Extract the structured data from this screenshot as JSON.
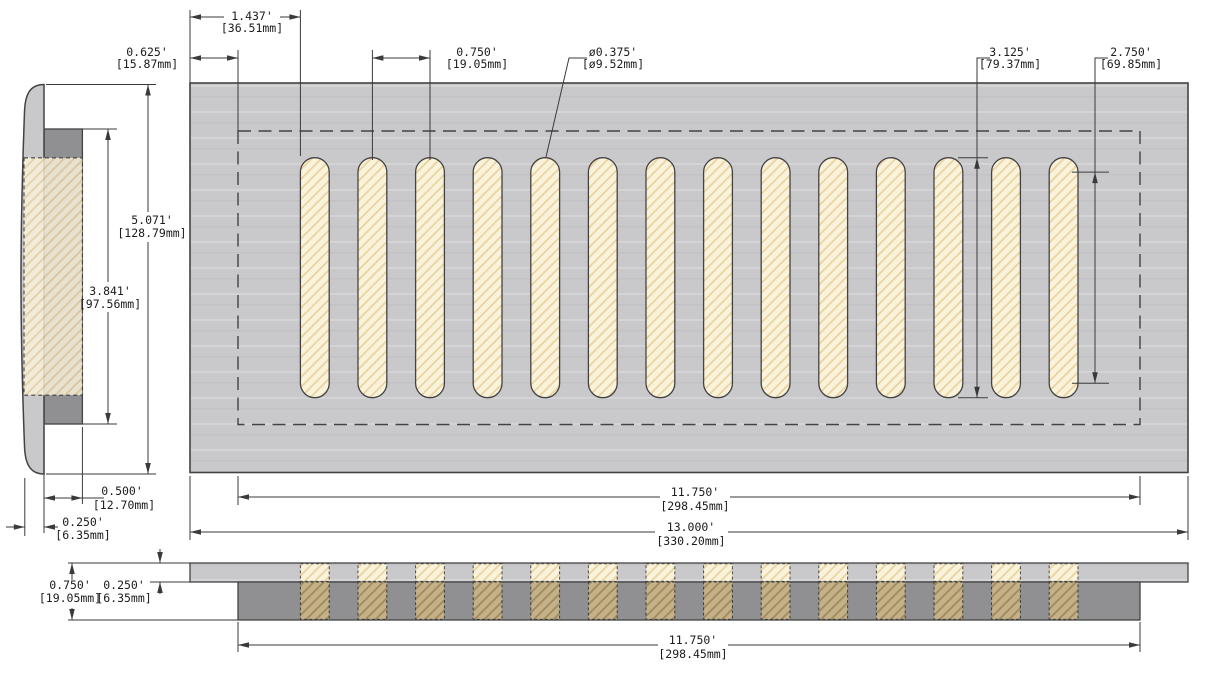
{
  "part": {
    "slot_count": 14
  },
  "colors": {
    "plate": "#c9c9cb",
    "plate_dark": "#909093",
    "slot_fill": "#faf3dc",
    "hatch_line": "#ecd3a0",
    "section_slot_bg": "#c2b189",
    "section_slot_line": "#a3895a",
    "outline": "#434343",
    "dim": "#3a3a3a"
  },
  "dims": {
    "slot_offset": {
      "in": "1.437'",
      "mm": "[36.51mm]"
    },
    "margin": {
      "in": "0.625'",
      "mm": "[15.87mm]"
    },
    "slot_pitch": {
      "in": "0.750'",
      "mm": "[19.05mm]"
    },
    "slot_width": {
      "in": "ø0.375'",
      "mm": "[ø9.52mm]"
    },
    "slot_length": {
      "in": "3.125'",
      "mm": "[79.37mm]"
    },
    "slot_straight": {
      "in": "2.750'",
      "mm": "[69.85mm]"
    },
    "cover_height": {
      "in": "5.071'",
      "mm": "[128.79mm]"
    },
    "duct_height": {
      "in": "3.841'",
      "mm": "[97.56mm]"
    },
    "duct_depth": {
      "in": "0.500'",
      "mm": "[12.70mm]"
    },
    "flange_offset": {
      "in": "0.250'",
      "mm": "[6.35mm]"
    },
    "duct_width": {
      "in": "11.750'",
      "mm": "[298.45mm]"
    },
    "cover_width": {
      "in": "13.000'",
      "mm": "[330.20mm]"
    },
    "section_height": {
      "in": "0.750'",
      "mm": "[19.05mm]"
    },
    "section_plate_thickness": {
      "in": "0.250'",
      "mm": "[6.35mm]"
    },
    "section_duct_width": {
      "in": "11.750'",
      "mm": "[298.45mm]"
    }
  }
}
